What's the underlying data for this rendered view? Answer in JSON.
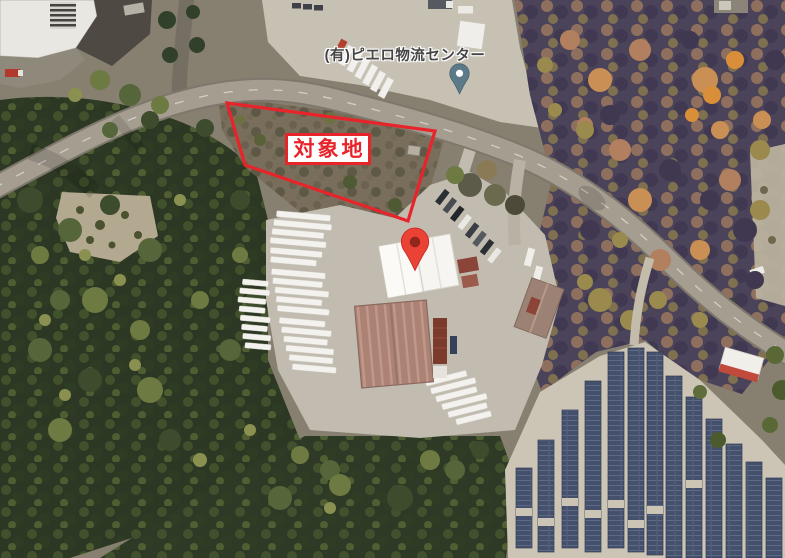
{
  "map": {
    "poi": {
      "label": "(有)ピエロ物流センター"
    },
    "site_overlay": {
      "label": "対象地",
      "outline_color": "#e8242b",
      "label_text_color": "#e8242b",
      "label_background": "#ffffff"
    },
    "markers": {
      "destination_pin_color": "#ea4335",
      "destination_pin_dot_color": "#93261c",
      "poi_pin_color": "#5d7a88",
      "poi_pin_dot_color": "#ffffff"
    }
  }
}
